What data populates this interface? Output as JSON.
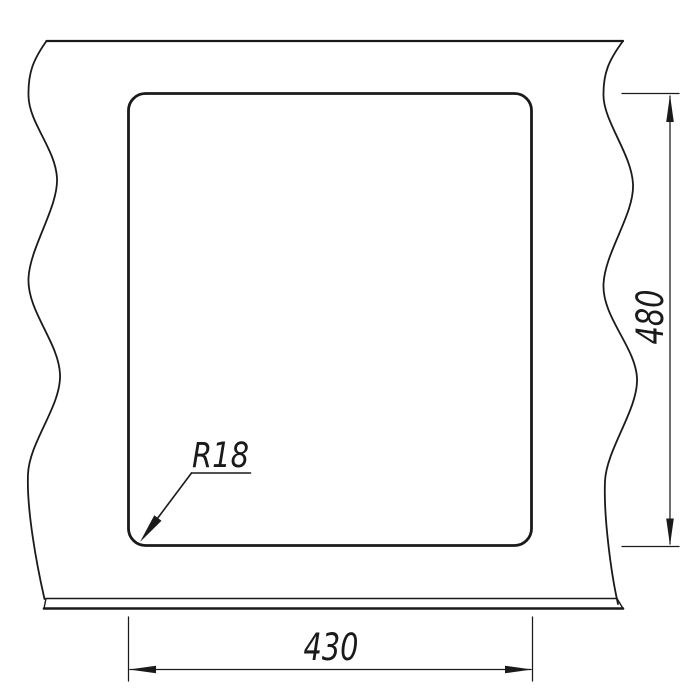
{
  "meta": {
    "ink": "#1a1a1a",
    "background": "#ffffff"
  },
  "drawing": {
    "kind": "technical-dimension-drawing",
    "dimensions": {
      "height": {
        "value": "480"
      },
      "width": {
        "value": "430"
      },
      "corner_radius": {
        "label": "R18"
      }
    }
  }
}
